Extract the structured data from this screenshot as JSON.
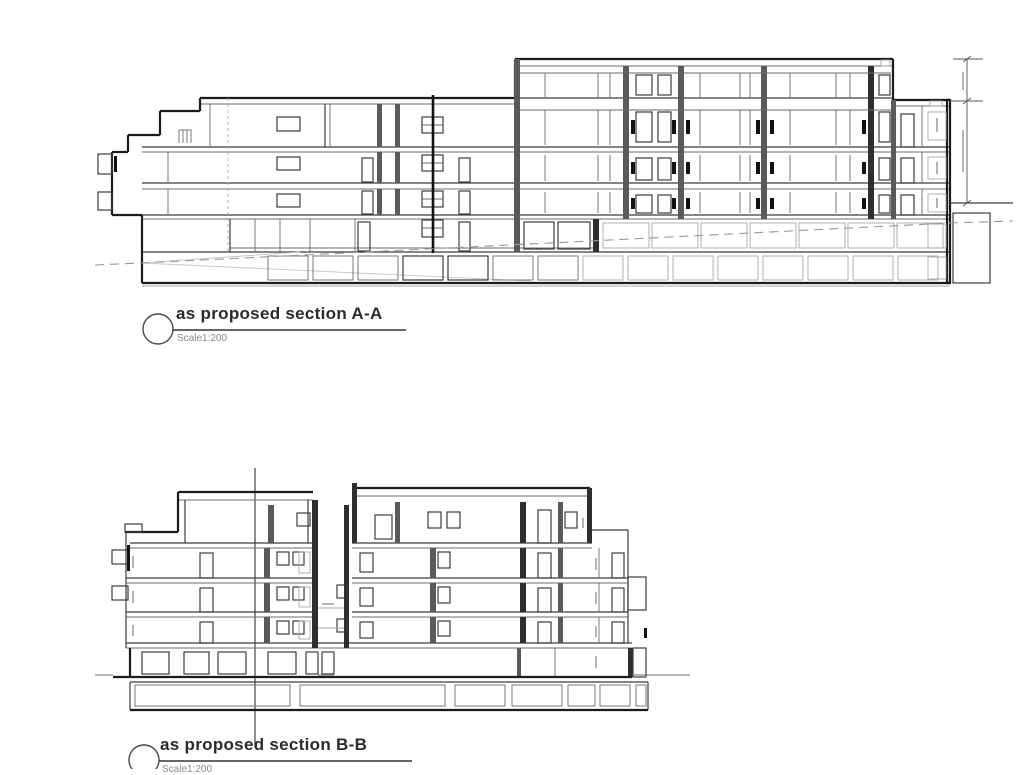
{
  "document": {
    "background_color": "#ffffff",
    "line_color": "#1b1b1b"
  },
  "sections": [
    {
      "label": "as proposed section A-A",
      "scale_label": "Scale1:200",
      "marker": "section-marker-circle"
    },
    {
      "label": "as proposed section B-B",
      "scale_label": "Scale1:200",
      "marker": "section-marker-circle"
    }
  ]
}
